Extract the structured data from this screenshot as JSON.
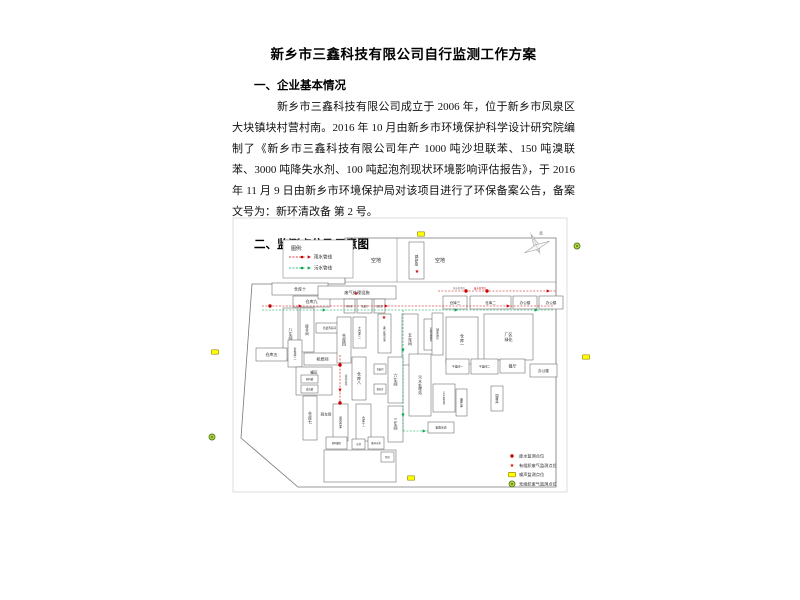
{
  "document": {
    "title": "新乡市三鑫科技有限公司自行监测工作方案",
    "section1_heading": "一、企业基本情况",
    "section1_paragraph": "新乡市三鑫科技有限公司成立于 2006 年，位于新乡市凤泉区大块镇块村营村南。2016 年 10 月由新乡市环境保护科学设计研究院编制了《新乡市三鑫科技有限公司年产 1000 吨沙坦联苯、150 吨溴联苯、3000 吨降失水剂、100 吨起泡剂现状环境影响评估报告》，于 2016 年 11 月 9 日由新乡市环境保护局对该项目进行了环保备案公告，备案文号为：新环清改备 第 2 号。",
    "section2_heading": "二、监测点位及示意图"
  },
  "diagram": {
    "colors": {
      "rain": "#cc0000",
      "sewage": "#00a651",
      "noise_fill": "#ffff00",
      "noise_stroke": "#9a8b00",
      "fugitive_fill": "#b5d334",
      "fugitive_stroke": "#54802a",
      "boundary": "#777777",
      "frame": "#c8c8c8"
    },
    "compass_label": "北",
    "pipe_legend": {
      "title": "图例:",
      "items": [
        {
          "label": "雨水管线",
          "color": "#cc0000"
        },
        {
          "label": "污水管线",
          "color": "#00a651"
        }
      ]
    },
    "marker_legend": [
      {
        "type": "dot",
        "label": "废水监测点位"
      },
      {
        "type": "star",
        "label": "有组织废气监测点位"
      },
      {
        "type": "rect",
        "label": "噪声监测点位"
      },
      {
        "type": "circle",
        "label": "无组织废气监测点位"
      }
    ],
    "frame": [
      233,
      218,
      334,
      274
    ],
    "boundary": [
      [
        345,
        238
      ],
      [
        556,
        238
      ],
      [
        556,
        487
      ],
      [
        298,
        487
      ],
      [
        241,
        438
      ],
      [
        252,
        284
      ],
      [
        345,
        284
      ]
    ],
    "lines": [
      [
        345,
        282,
        556,
        282
      ],
      [
        397,
        238,
        397,
        282
      ]
    ],
    "buildings": [
      {
        "x": 409,
        "y": 242,
        "w": 15,
        "h": 37,
        "l": "锅炉房",
        "o": "v",
        "fs": 3.6
      },
      {
        "x": 272,
        "y": 283,
        "w": 56,
        "h": 12,
        "l": "仓库十",
        "fs": 4
      },
      {
        "x": 293,
        "y": 296,
        "w": 37,
        "h": 11,
        "l": "仓库九",
        "fs": 4
      },
      {
        "x": 283,
        "y": 308,
        "w": 15,
        "h": 52,
        "l": "八车间",
        "o": "v",
        "fs": 4
      },
      {
        "x": 300,
        "y": 308,
        "w": 14,
        "h": 44,
        "l": "接合间",
        "o": "v",
        "fs": 3.4
      },
      {
        "x": 316,
        "y": 323,
        "w": 27,
        "h": 10,
        "l": "危废暂存间",
        "fs": 2.6
      },
      {
        "x": 256,
        "y": 348,
        "w": 31,
        "h": 13,
        "l": "仓库五",
        "fs": 4
      },
      {
        "x": 288,
        "y": 340,
        "w": 14,
        "h": 27,
        "l": "条件库二",
        "o": "v",
        "fs": 2.8
      },
      {
        "x": 304,
        "y": 353,
        "w": 37,
        "h": 12,
        "l": "机修间",
        "fs": 4
      },
      {
        "x": 296,
        "y": 367,
        "w": 36,
        "h": 28,
        "l": "",
        "fs": 3
      },
      {
        "x": 301,
        "y": 375,
        "w": 17,
        "h": 8,
        "l": "原料罐",
        "fs": 2.4
      },
      {
        "x": 301,
        "y": 385,
        "w": 17,
        "h": 8,
        "l": "成品罐",
        "fs": 2.4
      },
      {
        "x": 303,
        "y": 396,
        "w": 14,
        "h": 44,
        "l": "仓库七",
        "o": "v",
        "fs": 4
      },
      {
        "x": 333,
        "y": 404,
        "w": 15,
        "h": 37,
        "l": "闲置仓库",
        "o": "v",
        "fs": 2.8
      },
      {
        "x": 356,
        "y": 404,
        "w": 15,
        "h": 37,
        "l": "仓库十一",
        "o": "v",
        "fs": 2.8
      },
      {
        "x": 318,
        "y": 286,
        "w": 78,
        "h": 13,
        "l": "废气处理设施",
        "fs": 4.2
      },
      {
        "x": 344,
        "y": 299,
        "w": 11,
        "h": 14,
        "l": "配电室",
        "fs": 2.2
      },
      {
        "x": 357,
        "y": 299,
        "w": 15,
        "h": 14,
        "l": "危废库",
        "fs": 2.2
      },
      {
        "x": 374,
        "y": 299,
        "w": 11,
        "h": 14,
        "l": "值班室",
        "fs": 2.2
      },
      {
        "x": 337,
        "y": 317,
        "w": 14,
        "h": 46,
        "l": "仓库四",
        "o": "v",
        "fs": 4
      },
      {
        "x": 353,
        "y": 317,
        "w": 13,
        "h": 31,
        "l": "大仓库二",
        "o": "v",
        "fs": 2.8
      },
      {
        "x": 378,
        "y": 314,
        "w": 13,
        "h": 39,
        "l": "废气处理设施",
        "o": "v",
        "fs": 2.4
      },
      {
        "x": 402,
        "y": 314,
        "w": 16,
        "h": 51,
        "l": "五车间",
        "o": "v",
        "fs": 4
      },
      {
        "x": 424,
        "y": 319,
        "w": 14,
        "h": 31,
        "l": "安装设备区",
        "o": "v",
        "fs": 2.6
      },
      {
        "x": 352,
        "y": 357,
        "w": 14,
        "h": 43,
        "l": "仓库八",
        "o": "v",
        "fs": 4
      },
      {
        "x": 374,
        "y": 364,
        "w": 12,
        "h": 10,
        "l": "危废间",
        "fs": 2.2
      },
      {
        "x": 374,
        "y": 384,
        "w": 12,
        "h": 10,
        "l": "配电房",
        "fs": 2.2
      },
      {
        "x": 388,
        "y": 357,
        "w": 15,
        "h": 46,
        "l": "六车间",
        "o": "v",
        "fs": 4
      },
      {
        "x": 409,
        "y": 354,
        "w": 22,
        "h": 62,
        "l": "污水处理站",
        "o": "v",
        "fs": 3.6
      },
      {
        "x": 388,
        "y": 406,
        "w": 15,
        "h": 36,
        "l": "三车间",
        "o": "v",
        "fs": 4
      },
      {
        "x": 428,
        "y": 422,
        "w": 26,
        "h": 11,
        "l": "事故水池",
        "fs": 2.8
      },
      {
        "x": 432,
        "y": 313,
        "w": 11,
        "h": 42,
        "l": "辅助用房",
        "o": "v",
        "fs": 2.6
      },
      {
        "x": 446,
        "y": 317,
        "w": 32,
        "h": 47,
        "l": "仓库一",
        "o": "v",
        "fs": 4
      },
      {
        "x": 484,
        "y": 314,
        "w": 49,
        "h": 46,
        "l": "厂区绿化",
        "o": "h2",
        "fs": 4
      },
      {
        "x": 446,
        "y": 359,
        "w": 23,
        "h": 15,
        "l": "干燥间一",
        "fs": 2.8
      },
      {
        "x": 471,
        "y": 359,
        "w": 27,
        "h": 15,
        "l": "干燥间二",
        "fs": 2.8
      },
      {
        "x": 500,
        "y": 359,
        "w": 25,
        "h": 14,
        "l": "餐厅",
        "fs": 4
      },
      {
        "x": 530,
        "y": 364,
        "w": 27,
        "h": 13,
        "l": "办公楼",
        "fs": 3.6
      },
      {
        "x": 433,
        "y": 384,
        "w": 22,
        "h": 28,
        "l": "污水暂存池",
        "o": "v",
        "fs": 2.4
      },
      {
        "x": 456,
        "y": 389,
        "w": 11,
        "h": 27,
        "l": "备件库",
        "o": "v",
        "fs": 3
      },
      {
        "x": 491,
        "y": 386,
        "w": 12,
        "h": 25,
        "l": "固废库",
        "o": "v",
        "fs": 3
      },
      {
        "x": 443,
        "y": 296,
        "w": 24,
        "h": 13,
        "l": "仓库三",
        "fs": 3.6
      },
      {
        "x": 470,
        "y": 296,
        "w": 41,
        "h": 13,
        "l": "仓库二",
        "fs": 3.6
      },
      {
        "x": 513,
        "y": 296,
        "w": 24,
        "h": 13,
        "l": "办公楼",
        "fs": 3.6
      },
      {
        "x": 539,
        "y": 296,
        "w": 24,
        "h": 13,
        "l": "办公楼",
        "fs": 3.6
      },
      {
        "x": 326,
        "y": 437,
        "w": 21,
        "h": 12,
        "l": "原料罐区",
        "fs": 2.4
      },
      {
        "x": 352,
        "y": 439,
        "w": 13,
        "h": 10,
        "l": "水池",
        "fs": 2.4
      },
      {
        "x": 368,
        "y": 437,
        "w": 16,
        "h": 12,
        "l": "循环水池",
        "fs": 2.4
      },
      {
        "x": 324,
        "y": 450,
        "w": 72,
        "h": 32,
        "l": "",
        "fs": 3
      },
      {
        "x": 381,
        "y": 452,
        "w": 13,
        "h": 10,
        "l": "泵房",
        "fs": 2.4
      }
    ],
    "open_labels": [
      {
        "x": 376,
        "y": 260,
        "l": "空地",
        "fs": 5
      },
      {
        "x": 440,
        "y": 260,
        "l": "空地",
        "fs": 5
      },
      {
        "x": 314,
        "y": 372,
        "l": "罐区",
        "fs": 3.6
      },
      {
        "x": 326,
        "y": 414,
        "l": "回车场",
        "fs": 3.6
      },
      {
        "x": 346,
        "y": 380,
        "l": "运输道路",
        "o": "v",
        "fs": 2.6,
        "c": "#666666"
      }
    ],
    "tiny_notes": [
      {
        "x": 465,
        "y": 288,
        "l": "雨水监测点",
        "c": "#666666"
      },
      {
        "x": 486,
        "y": 288,
        "l": "废水监测点",
        "c": "#cc0000"
      }
    ],
    "pipes": {
      "rain": [
        [
          [
            262,
            306
          ],
          [
            554,
            306
          ]
        ],
        [
          [
            438,
            291
          ],
          [
            556,
            291
          ]
        ],
        [
          [
            340,
            355
          ],
          [
            340,
            404
          ]
        ]
      ],
      "sewage": [
        [
          [
            262,
            310
          ],
          [
            554,
            310
          ]
        ],
        [
          [
            403,
            310
          ],
          [
            403,
            431
          ]
        ],
        [
          [
            403,
            431
          ],
          [
            428,
            431
          ]
        ]
      ],
      "rain_arrows": [
        [
          300,
          306,
          0
        ],
        [
          386,
          306,
          0
        ],
        [
          508,
          306,
          0
        ],
        [
          548,
          291,
          0
        ],
        [
          340,
          390,
          90
        ]
      ],
      "sewage_arrows": [
        [
          324,
          310,
          0
        ],
        [
          456,
          310,
          0
        ],
        [
          536,
          310,
          0
        ],
        [
          403,
          350,
          90
        ],
        [
          403,
          415,
          90
        ],
        [
          424,
          431,
          0
        ]
      ]
    },
    "markers": {
      "wastewater_dots": [
        [
          270,
          306
        ],
        [
          466,
          291
        ],
        [
          487,
          291
        ],
        [
          340,
          365
        ],
        [
          340,
          403
        ]
      ],
      "stack_stars": [
        [
          417,
          271
        ],
        [
          356,
          293
        ],
        [
          384,
          317
        ]
      ],
      "noise_rects": [
        [
          421,
          234
        ],
        [
          215,
          352
        ],
        [
          586,
          357
        ],
        [
          411,
          478
        ]
      ],
      "fugitive_circles": [
        [
          577,
          246
        ],
        [
          212,
          437
        ]
      ]
    }
  }
}
